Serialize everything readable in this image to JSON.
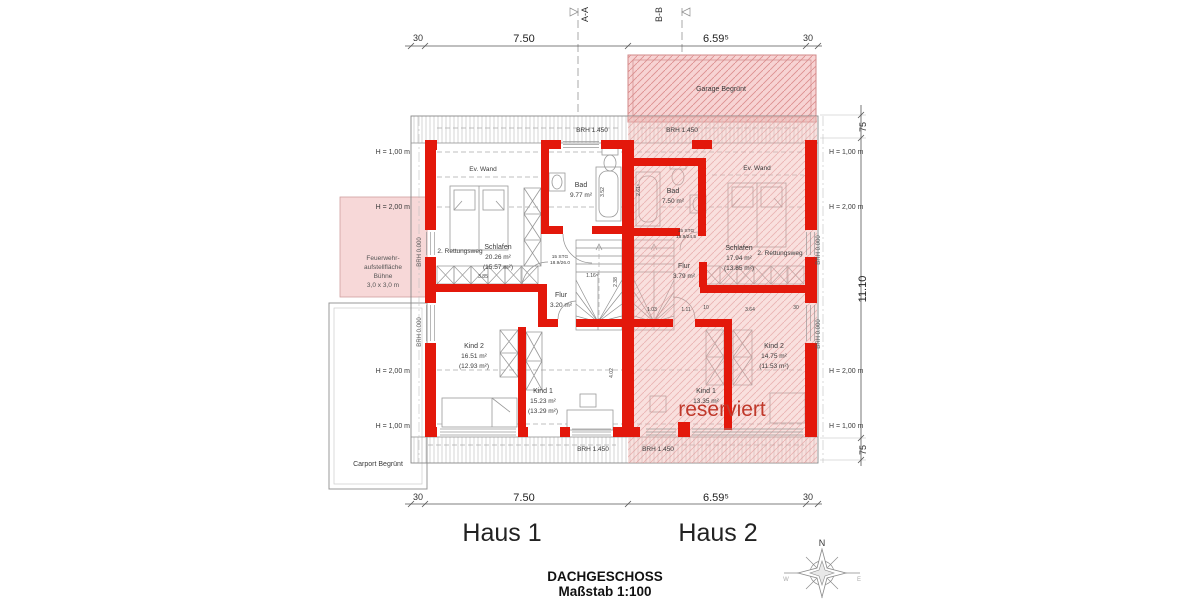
{
  "colors": {
    "wall": "#e3180b",
    "reservedFill": "#f0b4b0",
    "reservedText": "#c0392b",
    "hatchPink": "#f7d3d3"
  },
  "sections": {
    "a": "A-A",
    "b": "B-B"
  },
  "dims": {
    "top30a": "30",
    "top750": "7.50",
    "top659": "6.59⁵",
    "top30b": "30",
    "bot30a": "30",
    "bot750": "7.50",
    "bot659": "6.59⁵",
    "bot30b": "30",
    "r75a": "75",
    "r1110": "11.10",
    "r75b": "75",
    "d385": "3.85",
    "d116": "1.16⁵",
    "d238": "2.38",
    "d352": "3.52",
    "d402": "4.02",
    "d261": "2.61⁵",
    "d103": "1.03",
    "d111": "1.11",
    "d10": "10",
    "d364": "3.64",
    "d30": "30"
  },
  "site": {
    "garage": "Garage Begrünt",
    "carport": "Carport Begrünt",
    "fw1": "Feuerwehr-",
    "fw2": "aufstellfläche",
    "fw3": "Bühne",
    "fw4": "3,0 x 3,0 m"
  },
  "common": {
    "brhT1": "BRH 1.450",
    "brhT2": "BRH 1.450",
    "brhB1": "BRH 1.450",
    "brhB2": "BRH 1.450",
    "brh0L1": "BRH 0.000",
    "brh0L2": "BRH 0.000",
    "brh0R1": "BRH 0.000",
    "brh0R2": "BRH 0.000",
    "hL1": "H = 1,00 m",
    "hL2": "H = 2,00 m",
    "hL3": "H = 2,00 m",
    "hL4": "H = 1,00 m",
    "hR1": "H = 1,00 m",
    "hR2": "H = 2,00 m",
    "hR3": "H = 2,00 m",
    "hR4": "H = 1,00 m",
    "evWand1": "Ev. Wand",
    "evWand2": "Ev. Wand"
  },
  "h1": {
    "name": "Haus 1",
    "bad": "Bad",
    "badA": "9.77 m²",
    "schlafen": "Schlafen",
    "schlafenA": "20.26 m²",
    "schlafenB": "(15.57 m²)",
    "rettungsweg": "2. Rettungsweg",
    "stg1": "15 STG",
    "stg2": "18.9/26.0",
    "flur": "Flur",
    "flurA": "3.20 m²",
    "kind2": "Kind 2",
    "kind2A": "16.51 m²",
    "kind2B": "(12.93 m²)",
    "kind1": "Kind 1",
    "kind1A": "15.23 m²",
    "kind1B": "(13.29 m²)"
  },
  "h2": {
    "name": "Haus 2",
    "bad": "Bad",
    "badA": "7.50 m²",
    "schlafen": "Schlafen",
    "schlafenA": "17.94 m²",
    "schlafenB": "(13.85 m²)",
    "rettungsweg": "2. Rettungsweg",
    "stg1": "15 STG",
    "stg2": "18.9/24.5",
    "flur": "Flur",
    "flurA": "3.79 m²",
    "kind2": "Kind 2",
    "kind2A": "14.75 m²",
    "kind2B": "(11.53 m²)",
    "kind1": "Kind 1",
    "kind1A": "13.35 m²",
    "reserved": "reserviert"
  },
  "titleblock": {
    "title": "DACHGESCHOSS",
    "scale": "Maßstab 1:100"
  },
  "compass": {
    "n": "N",
    "w": "W",
    "e": "E"
  }
}
